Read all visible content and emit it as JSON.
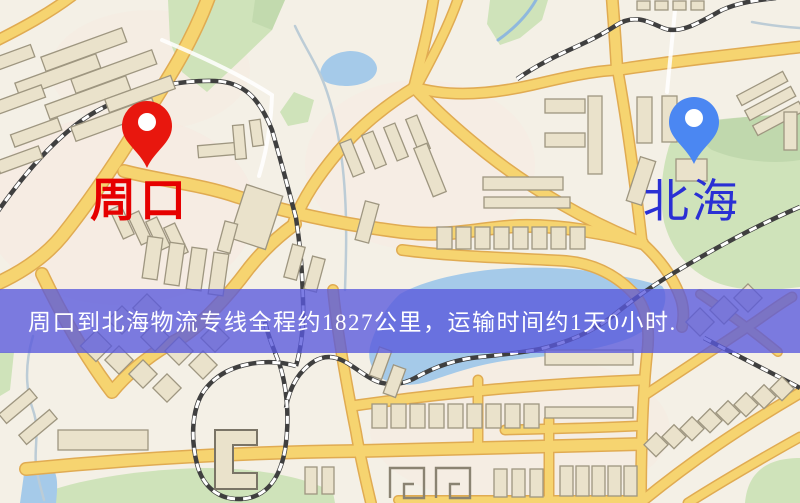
{
  "banner": {
    "text": "周口到北海物流专线全程约1827公里，运输时间约1天0小时.",
    "bg_color": "rgba(88,88,220,0.78)",
    "text_color": "#ffffff"
  },
  "markers": {
    "origin": {
      "label": "周口",
      "pin_color": "#e8170e",
      "label_color": "#e60000"
    },
    "destination": {
      "label": "北海",
      "pin_color": "#4b87f2",
      "label_color": "#2a30d4"
    }
  },
  "route": {
    "distance_km": "1827",
    "duration": "1天0小时"
  },
  "map_palette": {
    "background": "#f4f0e6",
    "residential": "#f8e7df",
    "road": "#f6d470",
    "road_casing": "#e0ab52",
    "railway": "#3f3f3f",
    "park": "#cfe3ba",
    "park_dark": "#b9d3a6",
    "water": "#a5cae9",
    "building": "#eae2cb",
    "building_stroke": "#9e9680",
    "pin_hole": "#ffffff"
  }
}
